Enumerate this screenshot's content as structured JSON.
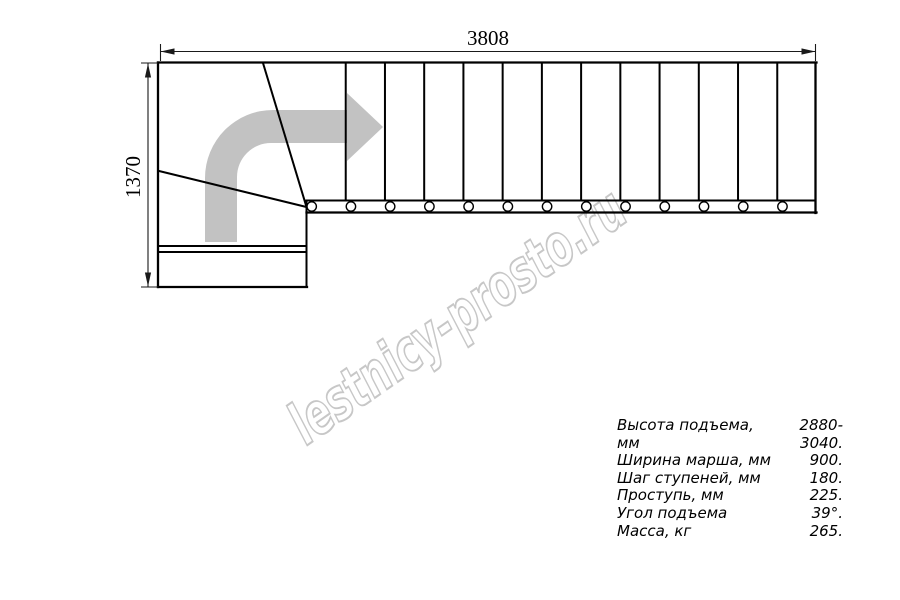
{
  "drawing": {
    "dimensions": {
      "top_width": "3808",
      "left_depth": "1370"
    },
    "plan": {
      "step_lines": 12,
      "balusters": 13
    },
    "colors": {
      "line": "#000000",
      "dimension": "#1a1a1a",
      "arrow_fill": "#c2c2c2",
      "watermark": "#c7c7c7",
      "background": "#ffffff"
    }
  },
  "watermark": {
    "text": "lestnicy-prosto.ru"
  },
  "specs": {
    "rows": [
      {
        "label": "Высота подъема, мм",
        "value": "2880-3040."
      },
      {
        "label": "Ширина марша, мм",
        "value": "900."
      },
      {
        "label": "Шаг ступеней, мм",
        "value": "180."
      },
      {
        "label": "Проступь, мм",
        "value": "225."
      },
      {
        "label": "Угол подъема",
        "value": "39°."
      },
      {
        "label": "Масса, кг",
        "value": "265."
      }
    ]
  }
}
